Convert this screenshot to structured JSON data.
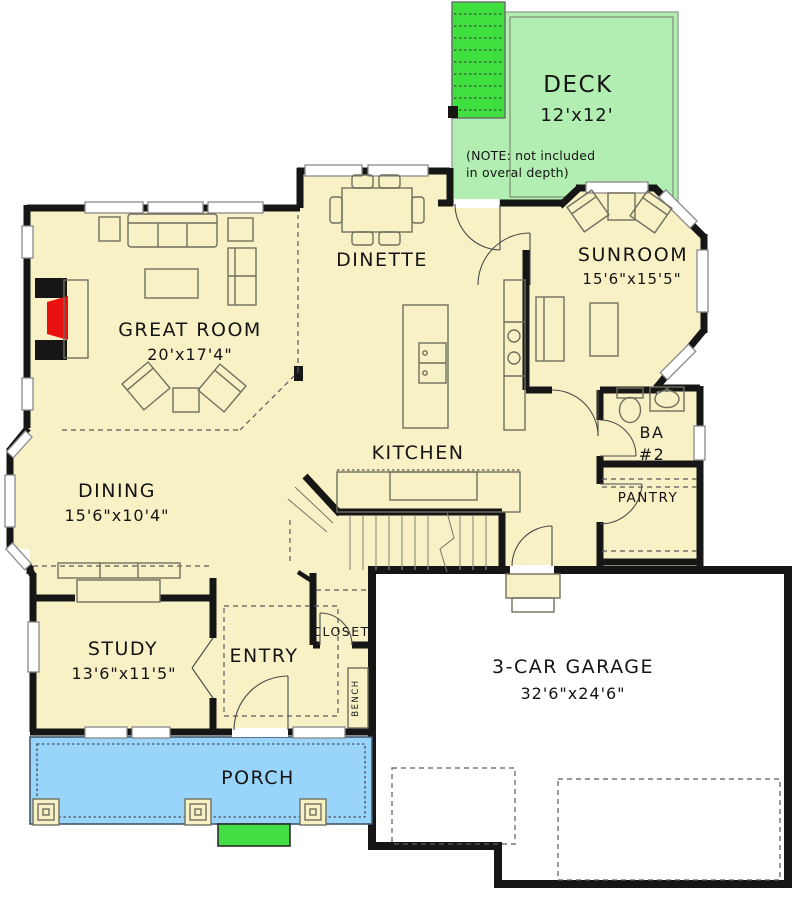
{
  "title": "House first-floor plan",
  "colors": {
    "room_fill": "#f8f1c6",
    "deck_fill": "#b2eeb2",
    "stair_fill": "#3fdf3f",
    "porch_fill": "#99d5fb",
    "stoop_fill": "#44dd44",
    "garage_fill": "#ffffff",
    "wall": "#161616",
    "fireplace": "#ea1111"
  },
  "rooms": {
    "deck": {
      "name": "DECK",
      "dims": "12'x12'",
      "note_line1": "(NOTE: not included",
      "note_line2": "in overal depth)"
    },
    "dinette": {
      "name": "DINETTE"
    },
    "sunroom": {
      "name": "SUNROOM",
      "dims": "15'6\"x15'5\""
    },
    "great_room": {
      "name": "GREAT ROOM",
      "dims": "20'x17'4\""
    },
    "kitchen": {
      "name": "KITCHEN"
    },
    "bath2": {
      "name": "BA",
      "number": "#2"
    },
    "pantry": {
      "name": "PANTRY"
    },
    "dining": {
      "name": "DINING",
      "dims": "15'6\"x10'4\""
    },
    "study": {
      "name": "STUDY",
      "dims": "13'6\"x11'5\""
    },
    "entry": {
      "name": "ENTRY"
    },
    "closet": {
      "name": "CLOSET"
    },
    "bench": {
      "name": "BENCH"
    },
    "garage": {
      "name": "3-CAR GARAGE",
      "dims": "32'6\"x24'6\""
    },
    "porch": {
      "name": "PORCH"
    }
  }
}
